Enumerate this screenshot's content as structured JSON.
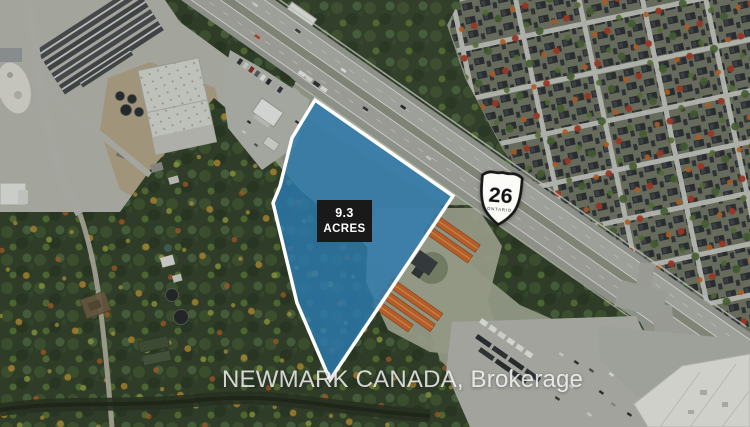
{
  "parcel": {
    "acreage_value": "9.3",
    "acreage_unit": "ACRES",
    "fill_color": "#2b7ab0",
    "border_color": "#ffffff",
    "label_bg_color": "#191919",
    "label_text_color": "#ffffff"
  },
  "highway_shield": {
    "route_number": "26",
    "province_label": "ONTARIO",
    "shield_fill": "#fbfbf8",
    "shield_border": "#161616"
  },
  "watermark": {
    "text": "NEWMARK CANADA, Brokerage",
    "color": "#ffffff"
  }
}
